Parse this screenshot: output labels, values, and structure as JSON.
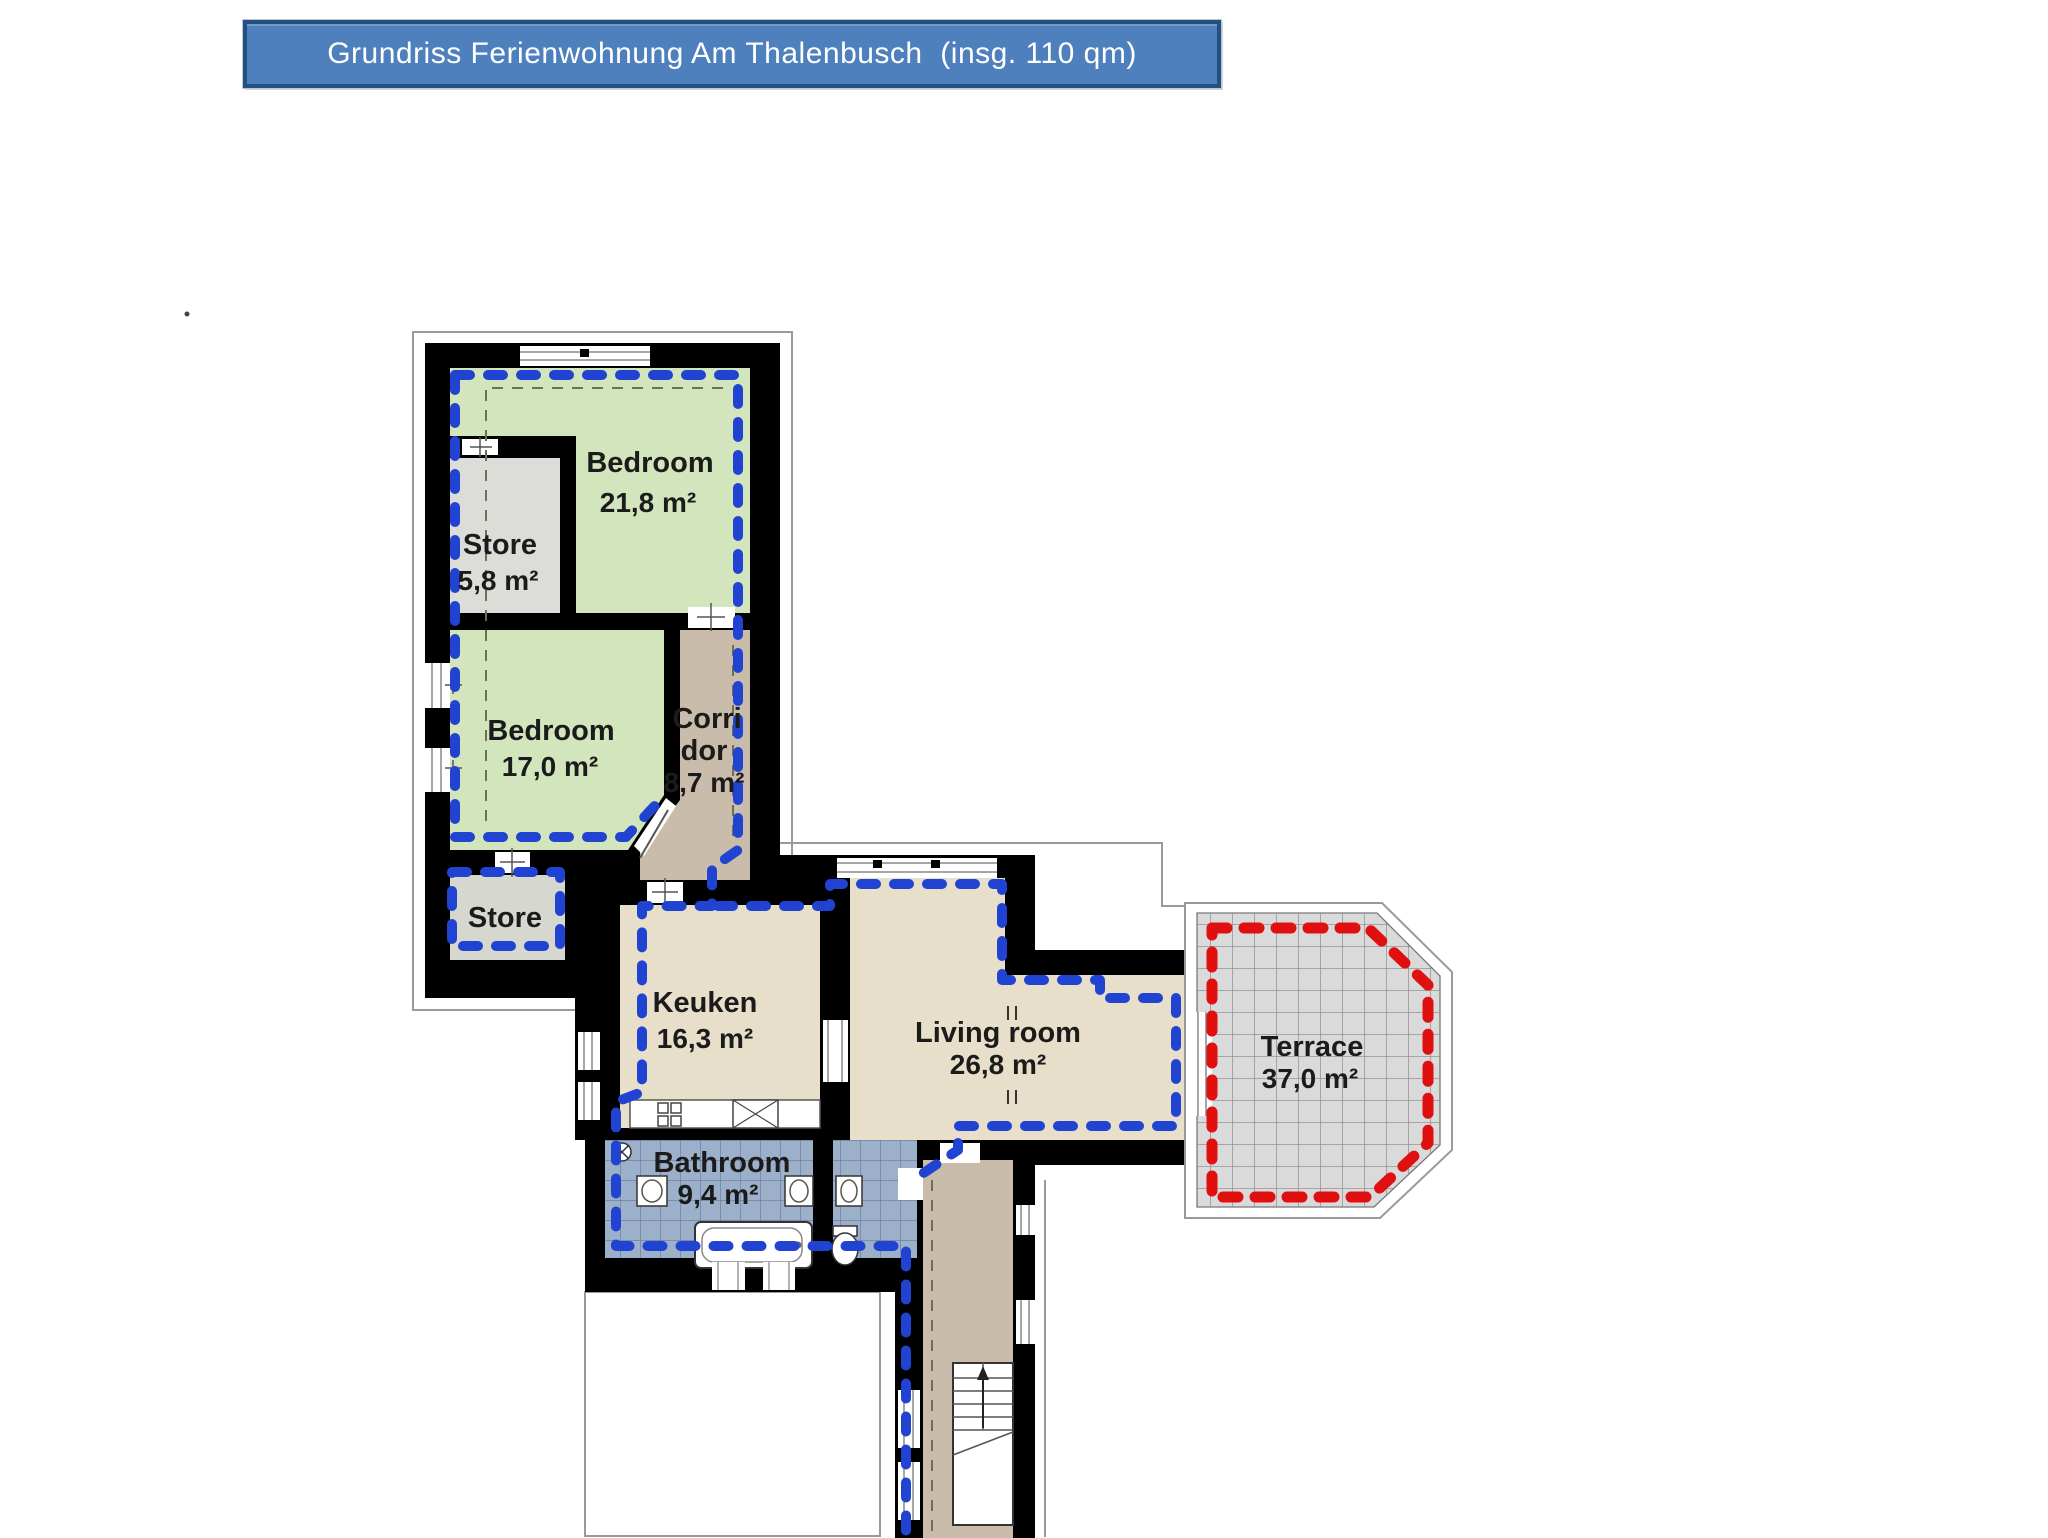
{
  "title": {
    "text": "Grundriss Ferienwohnung Am Thalenbusch  (insg. 110 qm)"
  },
  "colors": {
    "banner_fill": "#4d80bc",
    "banner_border": "#24507f",
    "wall": "#000000",
    "apartment_boundary_blue": "#2143d1",
    "terrace_boundary_red": "#e01010",
    "measure_dash_olive": "#6f6f52",
    "bedroom_green": "#d3e5bd",
    "store_gray": "#dcdcd8",
    "store2_gray": "#d6d8d0",
    "corridor_tan": "#c9bcaa",
    "kitchen_beige": "#e7dfc9",
    "bathroom_blue": "#9db0ca",
    "terrace_gray": "#dadada"
  },
  "rooms": [
    {
      "id": "bedroom-1",
      "name": "Bedroom",
      "area": "21,8 m²",
      "color": "#d3e5bd"
    },
    {
      "id": "store-1",
      "name": "Store",
      "area": "5,8 m²",
      "color": "#dcdcd8"
    },
    {
      "id": "bedroom-2",
      "name": "Bedroom",
      "area": "17,0 m²",
      "color": "#d3e5bd"
    },
    {
      "id": "corridor",
      "lines": [
        "Corri",
        "dor",
        "8,7 m²"
      ],
      "color": "#c9bcaa"
    },
    {
      "id": "store-2",
      "name": "Store",
      "area": "",
      "color": "#d6d8d0"
    },
    {
      "id": "kitchen",
      "name": "Keuken",
      "area": "16,3 m²",
      "color": "#e7dfc9"
    },
    {
      "id": "living-room",
      "name": "Living room",
      "area": "26,8 m²",
      "color": "#e7dfc9"
    },
    {
      "id": "bathroom",
      "name": "Bathroom",
      "area": "9,4 m²",
      "color": "#9db0ca"
    },
    {
      "id": "terrace",
      "name": "Terrace",
      "area": "37,0 m²",
      "color": "#dadada"
    }
  ]
}
